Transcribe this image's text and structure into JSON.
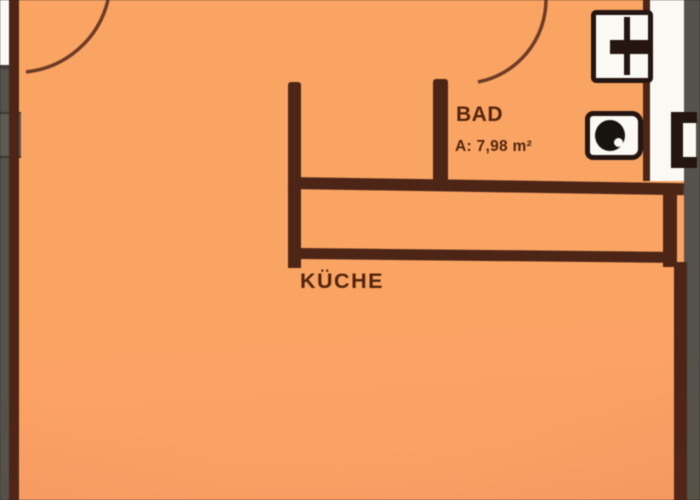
{
  "floorplan": {
    "bathroom": {
      "label": "BAD",
      "area": "A: 7,98 m²"
    },
    "kitchen": {
      "label": "KÜCHE"
    },
    "fixtures": {
      "sink": "sink-icon",
      "toilet": "toilet-icon"
    },
    "doors": {
      "count": 2,
      "style": "quarter-circle swing arcs"
    },
    "colors": {
      "floor": "#F8A465",
      "floor_deep": "#FB9F68",
      "wall": "#4C2518",
      "text": "#51250F",
      "outside": "#55524B",
      "white": "#FBF9F4",
      "fixture": "#241511"
    }
  }
}
